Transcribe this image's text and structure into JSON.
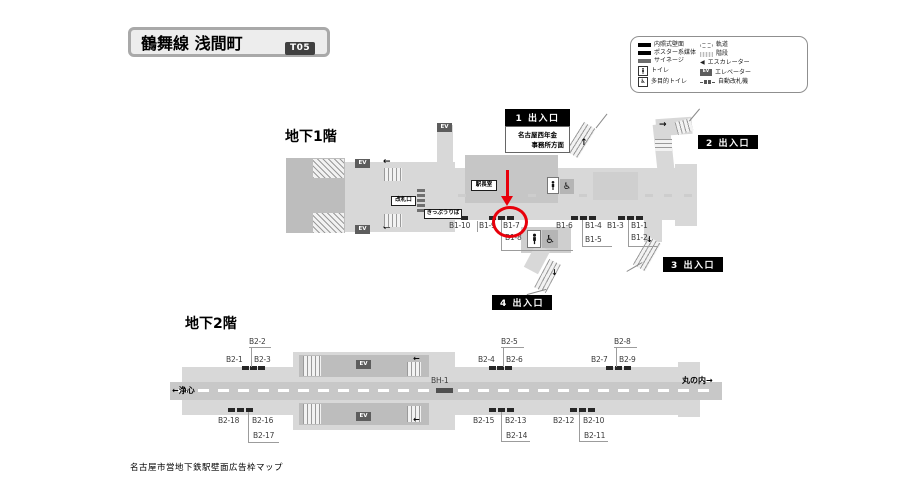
{
  "title": {
    "line_station": "鶴舞線 浅間町",
    "code": "T05"
  },
  "legend": {
    "left": [
      {
        "icon": "illuminated-wall-bar",
        "label": "内照式壁面"
      },
      {
        "icon": "poster-media-bar",
        "label": "ポスター系媒体"
      },
      {
        "icon": "signage-bar",
        "label": "サイネージ"
      },
      {
        "icon": "toilet",
        "label": "トイレ"
      },
      {
        "icon": "accessible-toilet",
        "label": "多目的トイレ"
      }
    ],
    "right": [
      {
        "icon": "track",
        "label": "軌道"
      },
      {
        "icon": "stairs",
        "label": "階段"
      },
      {
        "icon": "escalator",
        "label": "エスカレーター"
      },
      {
        "icon": "elevator",
        "label": "エレベーター"
      },
      {
        "icon": "ticket-gates",
        "label": "自動改札機"
      }
    ]
  },
  "b1": {
    "title": "地下1階",
    "exit1": "1 出入口",
    "exit2": "2 出入口",
    "exit3": "3 出入口",
    "exit4": "4 出入口",
    "exit1_note1": "名古屋西年金",
    "exit1_note2": "事務所方面",
    "rooms": {
      "office": "駅長室",
      "gate": "改札口",
      "tickets": "きっぷうりば"
    },
    "ads": {
      "b1_1": "B1-1",
      "b1_2": "B1-2",
      "b1_3": "B1-3",
      "b1_4": "B1-4",
      "b1_5": "B1-5",
      "b1_6": "B1-6",
      "b1_7": "B1-7",
      "b1_8": "B1-8",
      "b1_9": "B1-9",
      "b1_10": "B1-10"
    }
  },
  "b2": {
    "title": "地下2階",
    "dir_left": "←浄心",
    "dir_right": "丸の内→",
    "ads": {
      "b2_1": "B2-1",
      "b2_2": "B2-2",
      "b2_3": "B2-3",
      "b2_4": "B2-4",
      "b2_5": "B2-5",
      "b2_6": "B2-6",
      "b2_7": "B2-7",
      "b2_8": "B2-8",
      "b2_9": "B2-9",
      "b2_10": "B2-10",
      "b2_11": "B2-11",
      "b2_12": "B2-12",
      "b2_13": "B2-13",
      "b2_14": "B2-14",
      "b2_15": "B2-15",
      "b2_16": "B2-16",
      "b2_17": "B2-17",
      "b2_18": "B2-18",
      "bh_1": "BH-1"
    }
  },
  "annotation": {
    "type": "red-circle-and-arrow",
    "target_label": "B1-7",
    "color": "#e8000b"
  },
  "misc": {
    "ev": "EV",
    "arrow_left": "←",
    "arrow_up": "↑",
    "arrow_right": "→",
    "arrow_down": "↓",
    "esc_tri": "◀",
    "wheelchair": "♿"
  },
  "footer": "名古屋市営地下鉄駅壁面広告枠マップ"
}
